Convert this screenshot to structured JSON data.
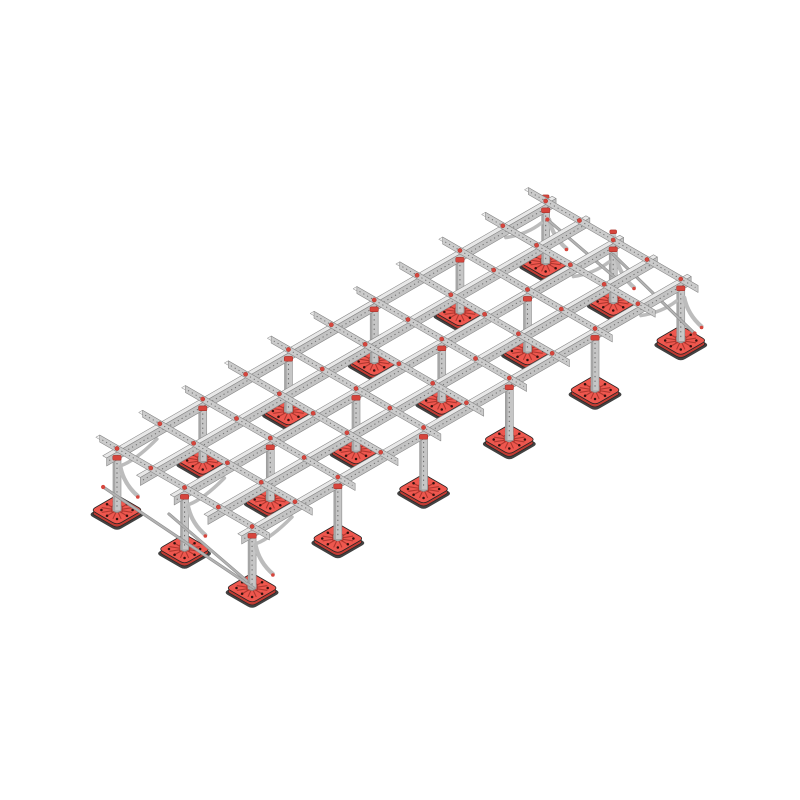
{
  "scene": {
    "width": 800,
    "height": 800,
    "background": "#ffffff",
    "description": "Isometric CAD rendering of a flat-roof support frame: galvanised strut-channel grid platform standing on red ballast feet with diagonal end bracing"
  },
  "palette": {
    "rail_side": "#c3c3c3",
    "rail_top": "#e8e8e8",
    "rail_edge": "#878787",
    "rafter_side": "#cbcbcb",
    "rafter_top": "#f0f0f0",
    "post_face": "#c6c6c6",
    "post_shade": "#a6a6a6",
    "post_edge": "#8d8d8d",
    "perforation": "#6f6f6f",
    "plate_top": "#ee574e",
    "plate_side": "#c23c34",
    "plate_rib": "#b03830",
    "plate_outline": "#2a2423",
    "plate_hole": "#33110e",
    "plate_mat": "#323232",
    "boss_fill": "#bdbdbd",
    "boss_edge": "#8a8a8a",
    "accent_red": "#d6453c",
    "cap_edge": "#9e2b24",
    "rod": "#b2b2b2",
    "gusset": "#bcbcbc"
  },
  "structure": {
    "origin": {
      "x": 117,
      "y": 510
    },
    "iso": {
      "ux": 0.866,
      "uy": -0.5,
      "vx": 0.866,
      "vy": 0.5
    },
    "columns": 6,
    "rows": 3,
    "bay_spacing": 99,
    "row_spacing": 78,
    "post_height": 50,
    "post_width": 8,
    "rail_v_offsets": [
      0,
      39,
      78,
      117,
      156
    ],
    "rail_overhang": 12,
    "rail_depth": 8,
    "rail_top_w": 4.5,
    "rafter_count": 11,
    "rafter_overhang": 20,
    "rafter_depth": 7,
    "rafter_top_w": 4.5,
    "plate_half": 15,
    "plate_corner": 5,
    "rib_count": 12,
    "rib_radius": 12.5,
    "hole_ring": [
      [
        -9,
        -9
      ],
      [
        9,
        -9
      ],
      [
        9,
        9
      ],
      [
        -9,
        9
      ],
      [
        -11.5,
        0
      ],
      [
        11.5,
        0
      ],
      [
        0,
        -11.5
      ],
      [
        0,
        11.5
      ]
    ]
  },
  "braces": {
    "rods": [
      {
        "from": [
          495,
          2,
          44
        ],
        "to": [
          495,
          80,
          25
        ],
        "tip_at": "from"
      },
      {
        "from": [
          495,
          78,
          47
        ],
        "to": [
          495,
          172,
          15
        ],
        "tip_at": "to"
      },
      {
        "from": [
          0,
          -16,
          15
        ],
        "to": [
          0,
          158,
          1
        ],
        "tip_at": "from"
      },
      {
        "from": [
          0,
          60,
          26
        ],
        "to": [
          0,
          150,
          4
        ],
        "tip_at": "none"
      }
    ],
    "stubs": [
      {
        "u": 495,
        "v": 0,
        "w1": 50,
        "w2": 64
      },
      {
        "u": 495,
        "v": 78,
        "w1": 50,
        "w2": 68
      }
    ],
    "gussets_v": [
      {
        "u": 0,
        "v": 0
      },
      {
        "u": 0,
        "v": 78
      },
      {
        "u": 0,
        "v": 156
      },
      {
        "u": 495,
        "v": 0
      },
      {
        "u": 495,
        "v": 78
      },
      {
        "u": 495,
        "v": 156
      }
    ],
    "gussets_u": [
      {
        "u": 0,
        "v": 0,
        "dir": 1
      },
      {
        "u": 0,
        "v": 78,
        "dir": 1
      },
      {
        "u": 0,
        "v": 156,
        "dir": 1
      },
      {
        "u": 495,
        "v": 0,
        "dir": -1
      },
      {
        "u": 495,
        "v": 78,
        "dir": -1
      },
      {
        "u": 495,
        "v": 156,
        "dir": -1
      }
    ]
  }
}
